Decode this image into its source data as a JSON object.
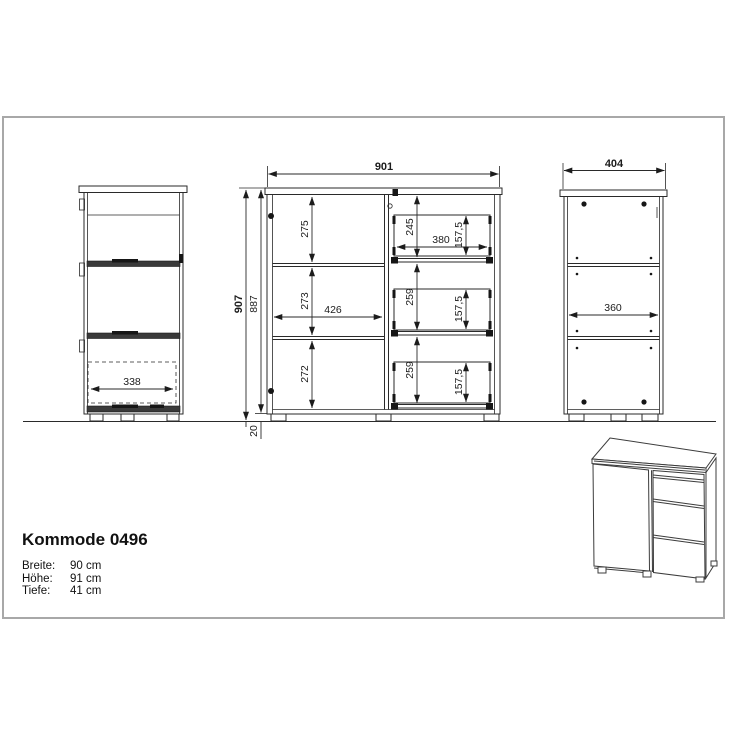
{
  "product": {
    "title": "Kommode 0496",
    "specs": [
      {
        "label": "Breite:",
        "value": "90 cm"
      },
      {
        "label": "Höhe:",
        "value": "91 cm"
      },
      {
        "label": "Tiefe:",
        "value": "41 cm"
      }
    ]
  },
  "drawing": {
    "colors": {
      "line": "#2a2a2a",
      "frame": "#a8a8a8",
      "background": "#ffffff"
    },
    "views": {
      "side_left": {
        "dims": {
          "inner_width": "338"
        }
      },
      "front": {
        "dims": {
          "width": "901",
          "comp_top": "275",
          "comp_mid": "273",
          "comp_bottom": "272",
          "door_inner_width": "426",
          "drawer_top_pitch": "245",
          "drawer_top_width": "380",
          "drawer_top_front": "157,5",
          "drawer_mid_pitch": "259",
          "drawer_mid_front": "157,5",
          "drawer_bot_pitch": "259",
          "drawer_bot_front": "157,5"
        }
      },
      "side_right": {
        "dims": {
          "depth": "404",
          "inner_depth": "360"
        }
      },
      "heights": {
        "dims": {
          "total": "907",
          "body": "887",
          "plinth": "20"
        }
      }
    }
  }
}
